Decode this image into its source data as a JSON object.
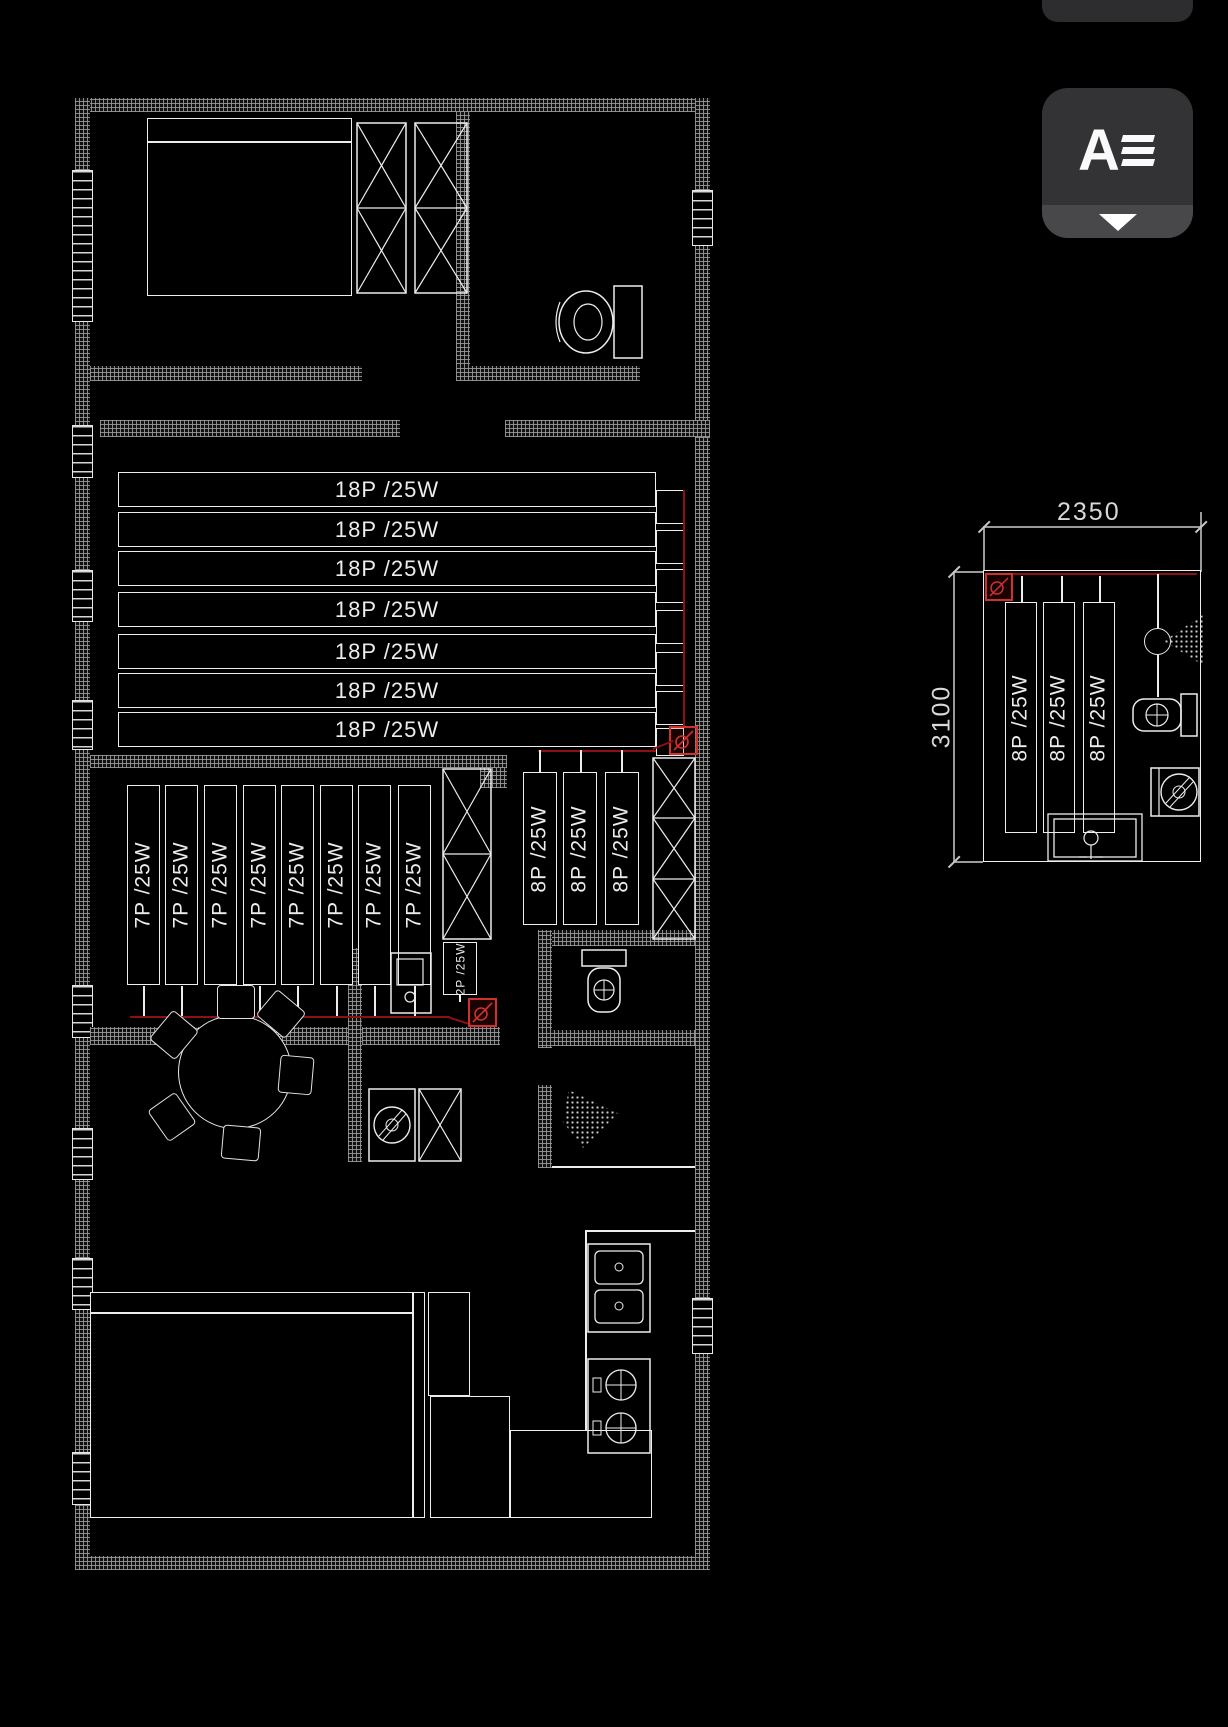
{
  "toolbar": {
    "style_button": {
      "icon_label": "A"
    }
  },
  "colors": {
    "background": "#000000",
    "line": "#ededed",
    "hatch": "#9e9e9e",
    "wire_red": "#8e1010",
    "socket_red": "#d03030",
    "dim_gray": "#9a9a9a"
  },
  "floorplan": {
    "shelf_rows_18p": {
      "labels": [
        "18P /25W",
        "18P /25W",
        "18P /25W",
        "18P /25W",
        "18P /25W",
        "18P /25W",
        "18P /25W"
      ]
    },
    "racks_7p": {
      "labels": [
        "7P /25W",
        "7P /25W",
        "7P /25W",
        "7P /25W",
        "7P /25W",
        "7P /25W",
        "7P /25W",
        "7P /25W"
      ]
    },
    "racks_8p": {
      "labels": [
        "8P /25W",
        "8P /25W",
        "8P /25W"
      ]
    },
    "rack_2p": {
      "label": "2P /25W"
    }
  },
  "detail_view": {
    "dim_width": "2350",
    "dim_height": "3100",
    "racks_8p": {
      "labels": [
        "8P /25W",
        "8P /25W",
        "8P /25W"
      ]
    }
  }
}
